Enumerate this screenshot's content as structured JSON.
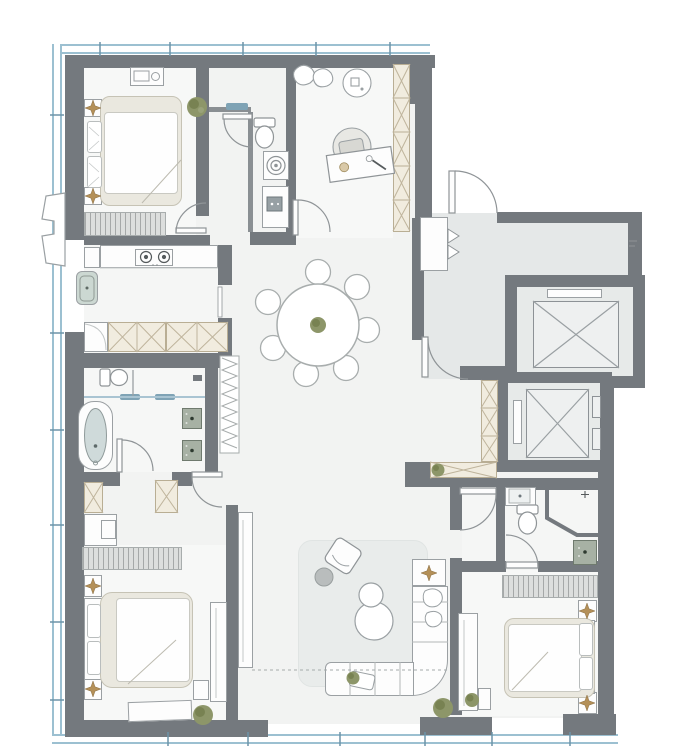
{
  "meta": {
    "kind": "residential-floor-plan",
    "view": "top-down",
    "no_visible_text": true
  },
  "palette": {
    "wall": "#74797e",
    "floor_main": "#f2f3f2",
    "floor_room": "#f7f8f7",
    "floor_foyer": "#e5e8e8",
    "window_blue": "#9cc0d1",
    "window_tick": "#6d94a8",
    "furniture_outline": "#9ba0a3",
    "furniture_fill": "#fdfdfd",
    "bedding_beige": "#eae8df",
    "cabinet_cream": "#f1ecdf",
    "cabinet_hatch": "#bfb49c",
    "vanity_green": "#a7b1a4",
    "bathtub_blue": "#cfdada",
    "plant_green": "#8d9669",
    "accent_tan": "#b49058",
    "glass_blue": "#7fa3b5"
  },
  "windows": {
    "top": true,
    "left": true,
    "bottom": true,
    "right": false
  },
  "rooms": [
    {
      "id": "bedroom-top-left",
      "furniture": [
        "double-bed",
        "nightstand",
        "nightstand",
        "tv-dresser",
        "wardrobe",
        "plant"
      ]
    },
    {
      "id": "laundry-wc",
      "furniture": [
        "toilet",
        "washing-machine",
        "utility-counter",
        "wall-shelf"
      ]
    },
    {
      "id": "study",
      "furniture": [
        "desk",
        "desk-chair",
        "pedestal-fan",
        "wardrobe",
        "floor-cushions"
      ]
    },
    {
      "id": "kitchen",
      "furniture": [
        "cooktop",
        "counter",
        "sink",
        "base-cabinets",
        "corner-cabinet"
      ]
    },
    {
      "id": "master-bathroom",
      "furniture": [
        "bathtub",
        "toilet",
        "vanity-sink",
        "vanity-sink",
        "glass-screen",
        "towel-radiator"
      ]
    },
    {
      "id": "dressing-area",
      "furniture": [
        "wardrobe",
        "wardrobe",
        "vanity-desk",
        "long-dresser"
      ]
    },
    {
      "id": "master-bedroom",
      "furniture": [
        "double-bed",
        "nightstand",
        "nightstand",
        "foot-bench",
        "tv-console",
        "side-table",
        "plant"
      ]
    },
    {
      "id": "living-dining",
      "dining_chair_count": 7,
      "furniture": [
        "round-dining-table",
        "dining-chair",
        "area-rug",
        "sectional-sofa",
        "coffee-table",
        "coffee-table",
        "armchair",
        "round-side-table",
        "sofa-side-table",
        "tv-bench",
        "floor-plant"
      ]
    },
    {
      "id": "foyer",
      "furniture": [
        "shoe-cabinet"
      ]
    },
    {
      "id": "hallway",
      "furniture": [
        "hall-wardrobe",
        "hall-cabinet",
        "plant"
      ]
    },
    {
      "id": "second-bathroom",
      "furniture": [
        "toilet",
        "corner-shower",
        "vanity-sink",
        "sink-cabinet"
      ]
    },
    {
      "id": "bedroom-right",
      "furniture": [
        "double-bed",
        "nightstand",
        "nightstand",
        "long-dresser",
        "tv-console",
        "plant"
      ]
    }
  ],
  "elevators": [
    {
      "id": "elevator-1",
      "symbol": "crossed-box"
    },
    {
      "id": "elevator-2",
      "symbol": "crossed-box"
    }
  ],
  "doors": [
    "entry-door",
    "foyer-inner-door",
    "study-door",
    "laundry-door",
    "bedroom-1-door",
    "master-bathroom-door",
    "dressing-door",
    "vestibule-door",
    "second-bathroom-door"
  ],
  "exterior_features": [
    "ac-platform-left",
    "window-tick-marks"
  ]
}
